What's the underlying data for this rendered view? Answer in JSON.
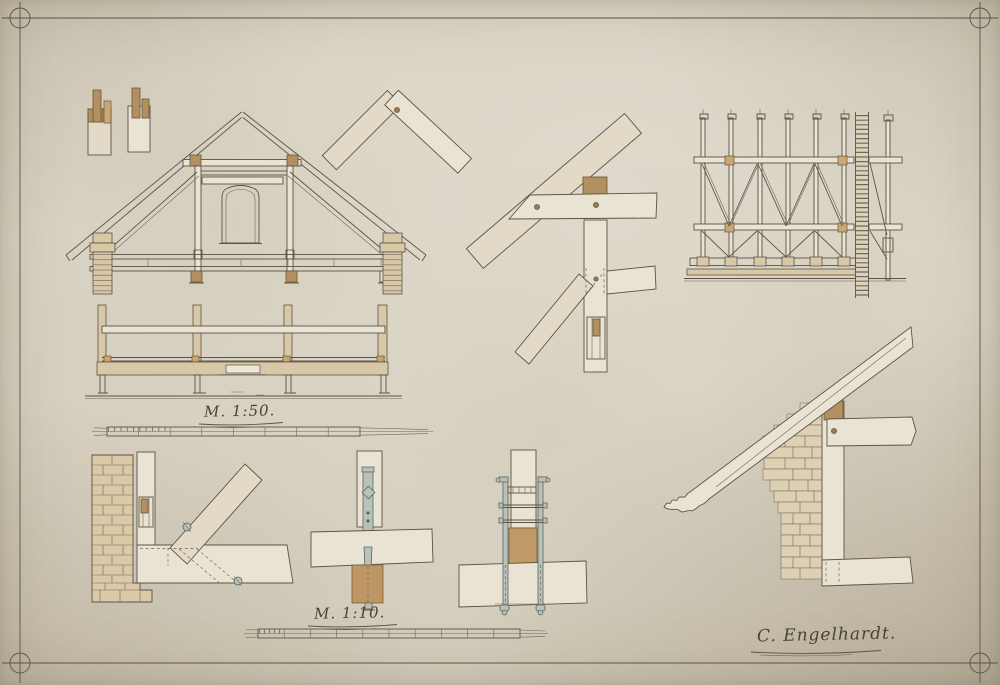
{
  "sheet": {
    "labels": {
      "scale_main": "M. 1:50.",
      "scale_detail": "M. 1:10.",
      "signature": "C. Engelhardt."
    },
    "colors": {
      "paper": "#d8d1c2",
      "ink": "#5b5347",
      "wood_light": "#e9e3d3",
      "wood_tan": "#d9c8a7",
      "accent_brown": "#b2905f",
      "metal_gray": "#b8c2bd"
    },
    "drawings": [
      {
        "id": "tenon-details",
        "label": "tenon joint details"
      },
      {
        "id": "roof-truss-section",
        "label": "roof truss cross-section with attic window"
      },
      {
        "id": "ridge-joint",
        "label": "ridge miter joint"
      },
      {
        "id": "purlin-post-joint",
        "label": "rafter, purlin and post joint"
      },
      {
        "id": "roof-framing-elevation",
        "label": "roof framing elevation with ladder strip"
      },
      {
        "id": "longitudinal-section",
        "label": "longitudinal beam elevation"
      },
      {
        "id": "wall-strut-detail",
        "label": "brick wall, post and strut detail"
      },
      {
        "id": "bolt-anchor-detail",
        "label": "iron bolt anchor detail"
      },
      {
        "id": "stirrup-anchor-detail",
        "label": "iron stirrup anchor detail"
      },
      {
        "id": "eaves-cornice-detail",
        "label": "eaves and brick cornice detail"
      }
    ]
  }
}
